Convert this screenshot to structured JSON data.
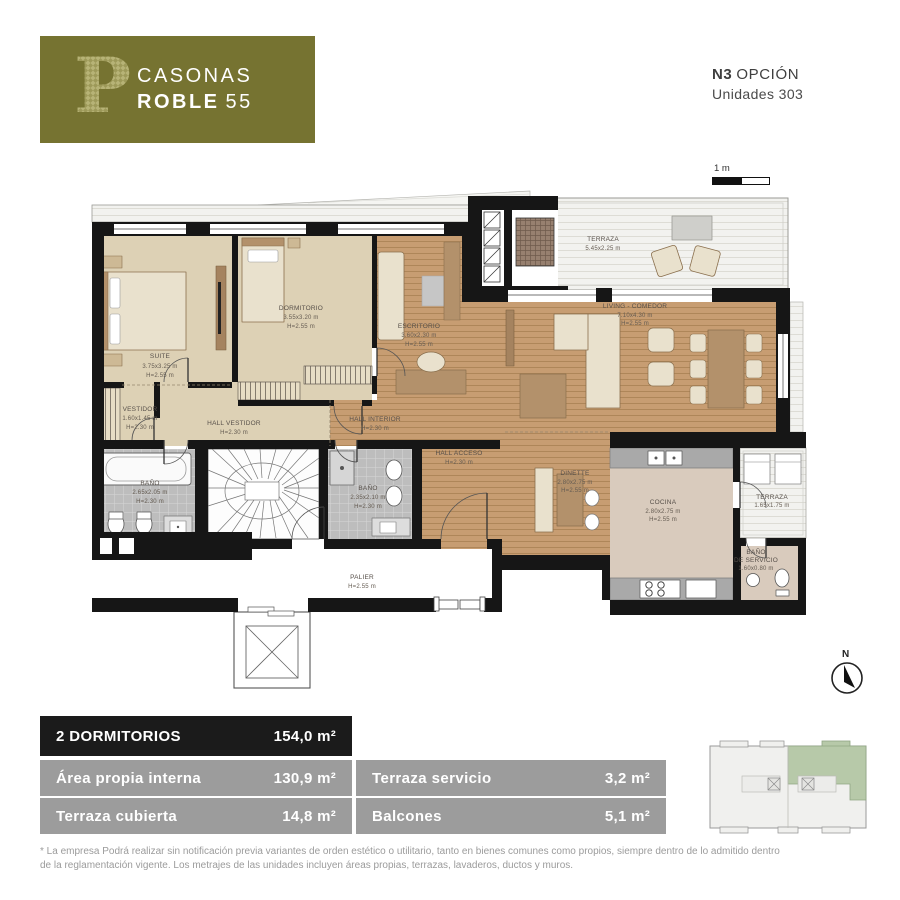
{
  "brand": {
    "letter": "P",
    "line1": "CASONAS",
    "line2_bold": "ROBLE",
    "line2_num": "55"
  },
  "header": {
    "option_bold": "N3",
    "option_rest": "OPCIÓN",
    "units": "Unidades 303"
  },
  "scale_bar": {
    "label": "1 m"
  },
  "north": {
    "label": "N"
  },
  "rooms": {
    "suite": {
      "name": "SUITE",
      "dim": "3.75x3.25 m",
      "h": "H=2.55 m"
    },
    "dormitorio": {
      "name": "DORMITORIO",
      "dim": "3.55x3.20 m",
      "h": "H=2.55 m"
    },
    "escritorio": {
      "name": "ESCRITORIO",
      "dim": "3.60x2.30 m",
      "h": "H=2.55 m"
    },
    "living": {
      "name": "LIVING - COMEDOR",
      "dim": "7.10x4.30 m",
      "h": "H=2.55 m"
    },
    "terraza": {
      "name": "TERRAZA",
      "dim": "5.45x2.25 m"
    },
    "vestidor": {
      "name": "VESTIDOR",
      "dim": "1.60x1.45 m",
      "h": "H=2.30 m"
    },
    "hall_vestidor": {
      "name": "HALL VESTIDOR",
      "h": "H=2.30 m"
    },
    "hall_interior": {
      "name": "HALL INTERIOR",
      "h": "H=2.30 m"
    },
    "hall_acceso": {
      "name": "HALL ACCESO",
      "h": "H=2.30 m"
    },
    "bano1": {
      "name": "BAÑO",
      "dim": "2.65x2.05 m",
      "h": "H=2.30 m"
    },
    "bano2": {
      "name": "BAÑO",
      "dim": "2.35x2.10 m",
      "h": "H=2.30 m"
    },
    "palier": {
      "name": "PALIER",
      "h": "H=2.55 m"
    },
    "dinette": {
      "name": "DINETTE",
      "dim": "2.80x2.75 m",
      "h": "H=2.55 m"
    },
    "cocina": {
      "name": "COCINA",
      "dim": "2.80x2.75 m",
      "h": "H=2.55 m"
    },
    "terraza_servicio": {
      "name": "TERRAZA",
      "dim": "1.65x1.75 m"
    },
    "bano_servicio": {
      "name": "BAÑO",
      "name2": "DE SERVICIO",
      "dim": "1.60x0.80 m"
    }
  },
  "summary": {
    "header": {
      "label": "2 DORMITORIOS",
      "value": "154,0 m²"
    },
    "rows_left": [
      {
        "label": "Área propia interna",
        "value": "130,9 m²"
      },
      {
        "label": "Terraza cubierta",
        "value": "14,8 m²"
      }
    ],
    "rows_right": [
      {
        "label": "Terraza servicio",
        "value": "3,2 m²"
      },
      {
        "label": "Balcones",
        "value": "5,1 m²"
      }
    ]
  },
  "footnote": {
    "line1": "* La empresa Podrá realizar sin notificación previa variantes de orden estético o utilitario, tanto en bienes comunes como propios, siempre dentro de lo admitido dentro",
    "line2": "de la reglamentación vigente. Los metrajes de las unidades incluyen áreas propias, terrazas, lavaderos, ductos y muros."
  },
  "colors": {
    "brand_olive": "#767331",
    "table_header": "#1b1b1b",
    "table_row": "#9c9c9c",
    "wood": "#c79d72",
    "carpet": "#ddd1b5",
    "tile": "#bdbdbd",
    "kitchen_floor": "#d9cbbd",
    "deck": "#f2f2ef",
    "highlight_green": "#b7c9a9"
  }
}
